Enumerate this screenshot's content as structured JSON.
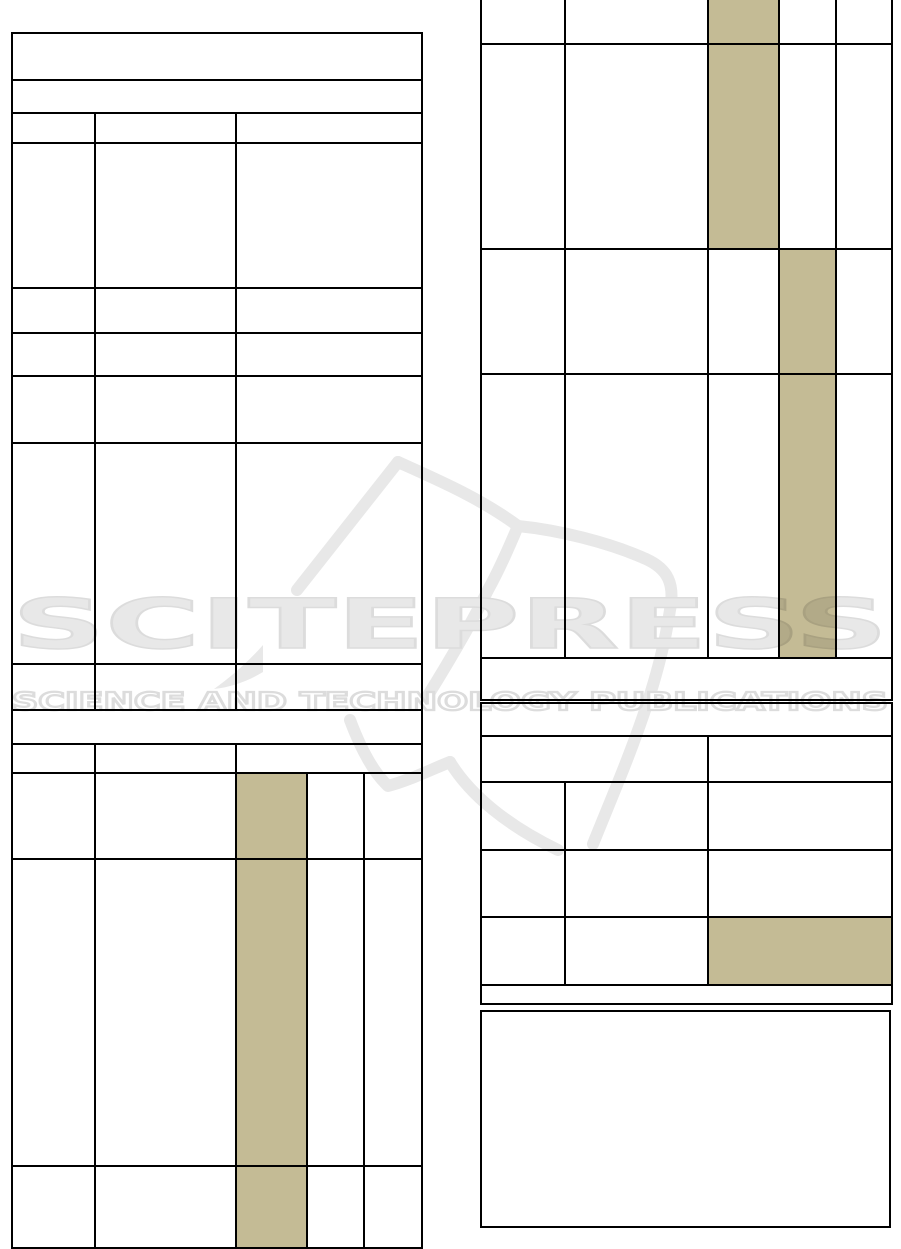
{
  "page": {
    "background": "#ffffff",
    "description": "Scanned publication page with empty bordered tables and SCITEPRESS watermark"
  },
  "colors": {
    "table_border": "#000000",
    "cell_highlight": "#c4bb95",
    "watermark_fill": "#e8e8e8",
    "watermark_edge": "#dcdcdc"
  },
  "watermark": {
    "title": "SCITEPRESS",
    "subtitle": "SCIENCE AND TECHNOLOGY PUBLICATIONS"
  },
  "tables": [
    {
      "name": "left-column-table",
      "x": 11,
      "y": 32,
      "width": 410,
      "col_widths": [
        83,
        141,
        71,
        57,
        58
      ],
      "rows": [
        {
          "h": 47,
          "cells": [
            {
              "span": 5
            }
          ]
        },
        {
          "h": 33,
          "cells": [
            {
              "span": 5
            }
          ]
        },
        {
          "h": 30,
          "cells": [
            {
              "span": 1
            },
            {
              "span": 1
            },
            {
              "span": 3
            }
          ]
        },
        {
          "h": 145,
          "cells": [
            {
              "span": 1
            },
            {
              "span": 1
            },
            {
              "span": 3
            }
          ]
        },
        {
          "h": 45,
          "cells": [
            {
              "span": 1
            },
            {
              "span": 1
            },
            {
              "span": 3
            }
          ]
        },
        {
          "h": 43,
          "cells": [
            {
              "span": 1
            },
            {
              "span": 1
            },
            {
              "span": 3
            }
          ]
        },
        {
          "h": 67,
          "cells": [
            {
              "span": 1
            },
            {
              "span": 1
            },
            {
              "span": 3
            }
          ]
        },
        {
          "h": 221,
          "cells": [
            {
              "span": 1
            },
            {
              "span": 1
            },
            {
              "span": 3
            }
          ]
        },
        {
          "h": 46,
          "cells": [
            {
              "span": 1
            },
            {
              "span": 1
            },
            {
              "span": 3
            }
          ]
        },
        {
          "h": 34,
          "cells": [
            {
              "span": 5
            }
          ]
        },
        {
          "h": 29,
          "cells": [
            {
              "span": 1
            },
            {
              "span": 1
            },
            {
              "span": 3
            }
          ]
        },
        {
          "h": 86,
          "cells": [
            {
              "span": 1
            },
            {
              "span": 1
            },
            {
              "span": 1,
              "highlighted": true
            },
            {
              "span": 1
            },
            {
              "span": 1
            }
          ]
        },
        {
          "h": 307,
          "cells": [
            {
              "span": 1
            },
            {
              "span": 1
            },
            {
              "span": 1,
              "highlighted": true
            },
            {
              "span": 1
            },
            {
              "span": 1
            }
          ]
        },
        {
          "h": 82,
          "cells": [
            {
              "span": 1
            },
            {
              "span": 1
            },
            {
              "span": 1,
              "highlighted": true
            },
            {
              "span": 1
            },
            {
              "span": 1
            }
          ]
        }
      ]
    },
    {
      "name": "right-top-table",
      "x": 480,
      "y": -24,
      "width": 411,
      "col_widths": [
        84,
        143,
        71,
        57,
        56
      ],
      "rows": [
        {
          "h": 67,
          "cells": [
            {
              "span": 1
            },
            {
              "span": 1
            },
            {
              "span": 1,
              "highlighted": true
            },
            {
              "span": 1
            },
            {
              "span": 1
            }
          ]
        },
        {
          "h": 205,
          "cells": [
            {
              "span": 1
            },
            {
              "span": 1
            },
            {
              "span": 1,
              "highlighted": true
            },
            {
              "span": 1
            },
            {
              "span": 1
            }
          ]
        },
        {
          "h": 125,
          "cells": [
            {
              "span": 1
            },
            {
              "span": 1
            },
            {
              "span": 1
            },
            {
              "span": 1,
              "highlighted": true
            },
            {
              "span": 1
            }
          ]
        },
        {
          "h": 284,
          "cells": [
            {
              "span": 1
            },
            {
              "span": 1
            },
            {
              "span": 1
            },
            {
              "span": 1,
              "highlighted": true
            },
            {
              "span": 1
            }
          ]
        },
        {
          "h": 42,
          "cells": [
            {
              "span": 5
            }
          ]
        }
      ]
    },
    {
      "name": "right-middle-table",
      "x": 480,
      "y": 702,
      "width": 411,
      "col_widths": [
        84,
        143,
        71,
        57,
        56
      ],
      "rows": [
        {
          "h": 33,
          "cells": [
            {
              "span": 5
            }
          ]
        },
        {
          "h": 46,
          "cells": [
            {
              "span": 2
            },
            {
              "span": 3
            }
          ]
        },
        {
          "h": 68,
          "cells": [
            {
              "span": 1
            },
            {
              "span": 1
            },
            {
              "span": 3
            }
          ]
        },
        {
          "h": 67,
          "cells": [
            {
              "span": 1
            },
            {
              "span": 1
            },
            {
              "span": 3
            }
          ]
        },
        {
          "h": 68,
          "cells": [
            {
              "span": 1
            },
            {
              "span": 1
            },
            {
              "span": 3,
              "highlighted": true
            }
          ]
        },
        {
          "h": 19,
          "cells": [
            {
              "span": 5
            }
          ]
        }
      ]
    }
  ],
  "figure_box": {
    "x": 480,
    "y": 1010,
    "width": 411,
    "height": 218
  }
}
